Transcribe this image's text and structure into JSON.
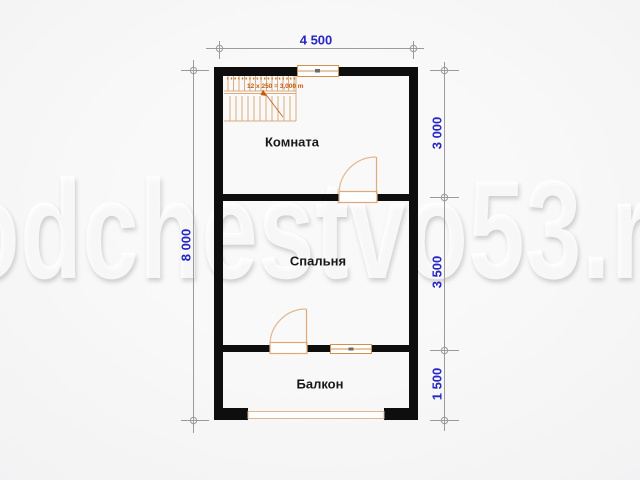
{
  "watermark": {
    "text": "odchestvo53.r"
  },
  "plan": {
    "rooms": [
      {
        "name": "Комната"
      },
      {
        "name": "Спальня"
      },
      {
        "name": "Балкон"
      }
    ],
    "stairs": {
      "label": "12 x 250 = 3,000 m"
    }
  },
  "dimensions": {
    "width_total": "4 500",
    "height_total": "8 000",
    "right_segments": [
      "3 000",
      "3 500",
      "1 500"
    ]
  },
  "colors": {
    "wall": "#0e0e0e",
    "fixture": "#dfa878",
    "annotation": "#c55a11",
    "dimension_line": "#9b9b9b",
    "dimension_text": "#2626c4"
  }
}
